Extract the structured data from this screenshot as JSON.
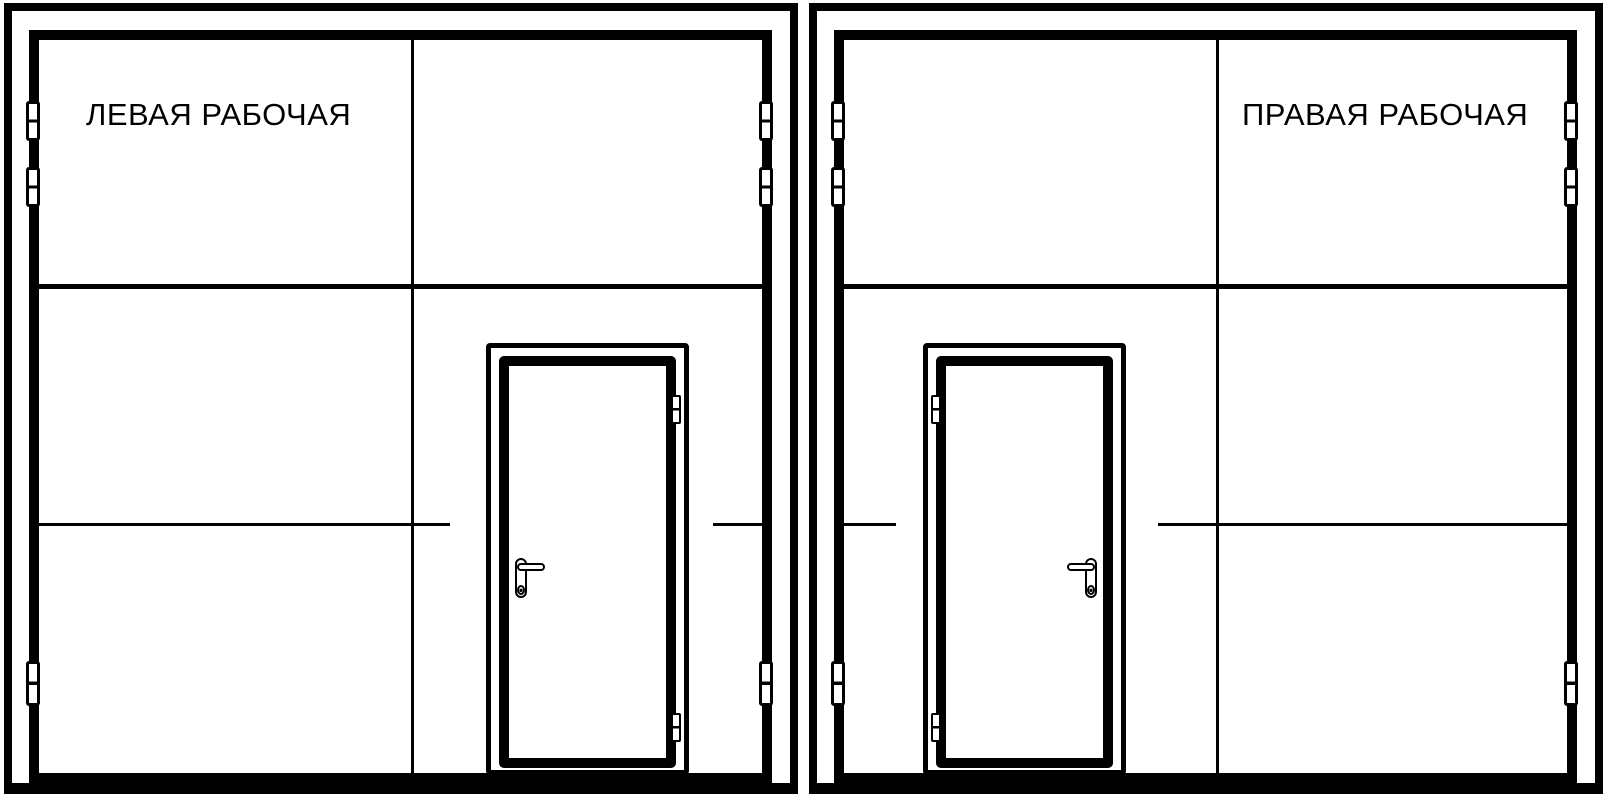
{
  "drawing": {
    "background_color": "#ffffff",
    "line_color": "#000000",
    "panels": [
      {
        "id": "left-working",
        "label": "ЛЕВАЯ РАБОЧАЯ"
      },
      {
        "id": "right-working",
        "label": "ПРАВАЯ РАБОЧАЯ"
      }
    ]
  }
}
